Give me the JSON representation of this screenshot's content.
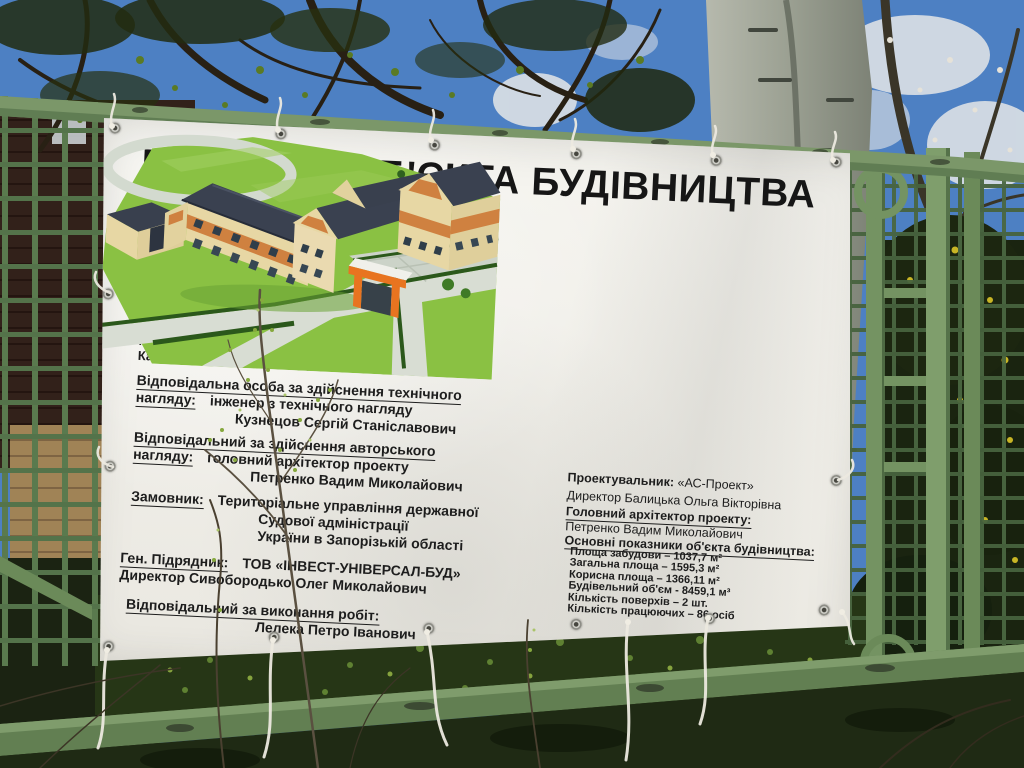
{
  "banner": {
    "title": "ПАСПОРТ ОБ'ЄКТА БУДІВНИЦТВА",
    "subtitle": {
      "line1": "«Реконструкція будівлі (літ. А-2, А')",
      "line2": "під будівлю суду за адресою:",
      "line3": "вул. Перемоги, 107б, м. Запоріжжя»"
    },
    "declaration": {
      "line1": "Декларація на початок робіт: від 03.04.2017",
      "line2": "серія № ЗП 083170881508",
      "line3": "Видана Департаментом державної",
      "line4": "архітектурно- будівельної",
      "line5": "інспекції у Запорізькій області",
      "line6": "Категорія складності: III (третя)"
    },
    "tech_supervision": {
      "heading_line1": "Відповідальна особа за здійснення технічного",
      "heading_line2": "нагляду:",
      "value_line1": "інженер з технічного нагляду",
      "value_line2": "Кузнецов Сергій Станіславович"
    },
    "author_supervision": {
      "heading_line1": "Відповідальний за здійснення авторського",
      "heading_line2": "нагляду:",
      "value_line1": "головний архітектор проекту",
      "value_line2": "Петренко Вадим Миколайович"
    },
    "customer": {
      "label": "Замовник:",
      "line1": "Територіальне управління державної",
      "line2": "Судової адміністрації",
      "line3": "України в Запорізькій області"
    },
    "contractor": {
      "label": "Ген. Підрядник:",
      "name": "ТОВ «ІНВЕСТ-УНІВЕРСАЛ-БУД»",
      "director": "Директор Сивобородько Олег Миколайович"
    },
    "works_responsible": {
      "heading": "Відповідальний за виконання робіт:",
      "name": "Лелека Петро Іванович"
    },
    "designer": {
      "label": "Проектувальник:",
      "name": "«АС-Проект»",
      "director": "Директор Балицька Ольга Вікторівна"
    },
    "chief_architect": {
      "heading": "Головний архітектор проекту:",
      "name": "Петренко Вадим Миколайович"
    },
    "indicators": {
      "heading": "Основні показники об'єкта будівництва:",
      "items": [
        "Площа забудови – 1037,7 м²",
        "Загальна площа – 1595,3 м²",
        "Корисна площа – 1366,11 м²",
        "Будівельний об'єм - 8459,1 м³",
        "Кількість поверхів – 2 шт.",
        "Кількість працюючих – 86 осіб"
      ]
    }
  },
  "colors": {
    "sky_blue": "#4d80c3",
    "fence_green": "#6f8f5e",
    "banner_white": "#f4f3ee",
    "text_black": "#1d1d1d",
    "lawn_green": "#8ac143",
    "roof_slate": "#3a4150",
    "wall_cream": "#e7d7a4",
    "wall_orange": "#cf8140",
    "canopy_orange": "#e87420",
    "birch_gray": "#a3a79a"
  }
}
